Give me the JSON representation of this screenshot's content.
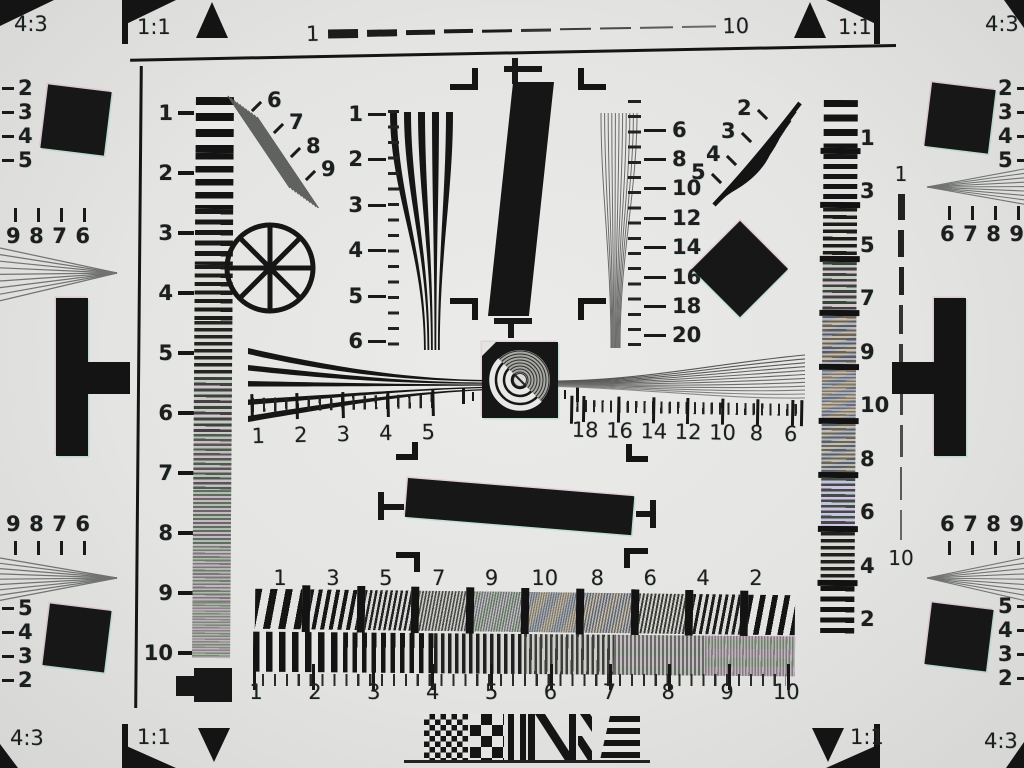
{
  "colors": {
    "paper": "#e4e4e2",
    "ink": "#171717",
    "fine_gray": "#8f918e"
  },
  "corners": {
    "top_left": {
      "aspect": "4:3",
      "square": "1:1"
    },
    "top_right": {
      "aspect": "4:3",
      "square": "1:1"
    },
    "bottom_left": {
      "aspect": "4:3",
      "square": "1:1"
    },
    "bottom_right": {
      "aspect": "4:3",
      "square": "1:1"
    }
  },
  "scales": {
    "top_dashes": {
      "start": "1",
      "end": "10"
    },
    "right_dashes": {
      "start": "1",
      "end": "10"
    },
    "left_wedge": [
      "1",
      "2",
      "3",
      "4",
      "5",
      "6",
      "7",
      "8",
      "9",
      "10"
    ],
    "right_wedge": [
      "1",
      "3",
      "5",
      "7",
      "9",
      "10",
      "8",
      "6",
      "4",
      "2"
    ],
    "upper_left_fan": [
      "6",
      "7",
      "8",
      "9"
    ],
    "upper_right_fan": [
      "2",
      "3",
      "4",
      "5"
    ],
    "center_left_vertical": [
      "1",
      "2",
      "3",
      "4",
      "5",
      "6"
    ],
    "center_right_vertical": [
      "6",
      "8",
      "10",
      "12",
      "14",
      "16",
      "18",
      "20"
    ],
    "center_left_horizontal": [
      "1",
      "2",
      "3",
      "4",
      "5"
    ],
    "center_right_horizontal": [
      "18",
      "16",
      "14",
      "12",
      "10",
      "8",
      "6"
    ],
    "bottom_coarse": [
      "1",
      "3",
      "5",
      "7",
      "9",
      "10",
      "8",
      "6",
      "4",
      "2"
    ],
    "bottom_fine": [
      "1",
      "2",
      "3",
      "4",
      "5",
      "6",
      "7",
      "8",
      "9",
      "10"
    ]
  },
  "edge_left": {
    "top_hyperbola_numbers": [
      "2",
      "3",
      "4",
      "5"
    ],
    "top_digits": [
      "9",
      "8",
      "7",
      "6"
    ],
    "bottom_digits": [
      "9",
      "8",
      "7",
      "6"
    ],
    "bottom_hyperbola_numbers": [
      "5",
      "4",
      "3",
      "2"
    ]
  },
  "edge_right": {
    "top_hyperbola_numbers": [
      "2",
      "3",
      "4",
      "5"
    ],
    "top_digits": [
      "6",
      "7",
      "8",
      "9"
    ],
    "bottom_digits": [
      "6",
      "7",
      "8",
      "9"
    ],
    "bottom_hyperbola_numbers": [
      "5",
      "4",
      "3",
      "2"
    ]
  }
}
